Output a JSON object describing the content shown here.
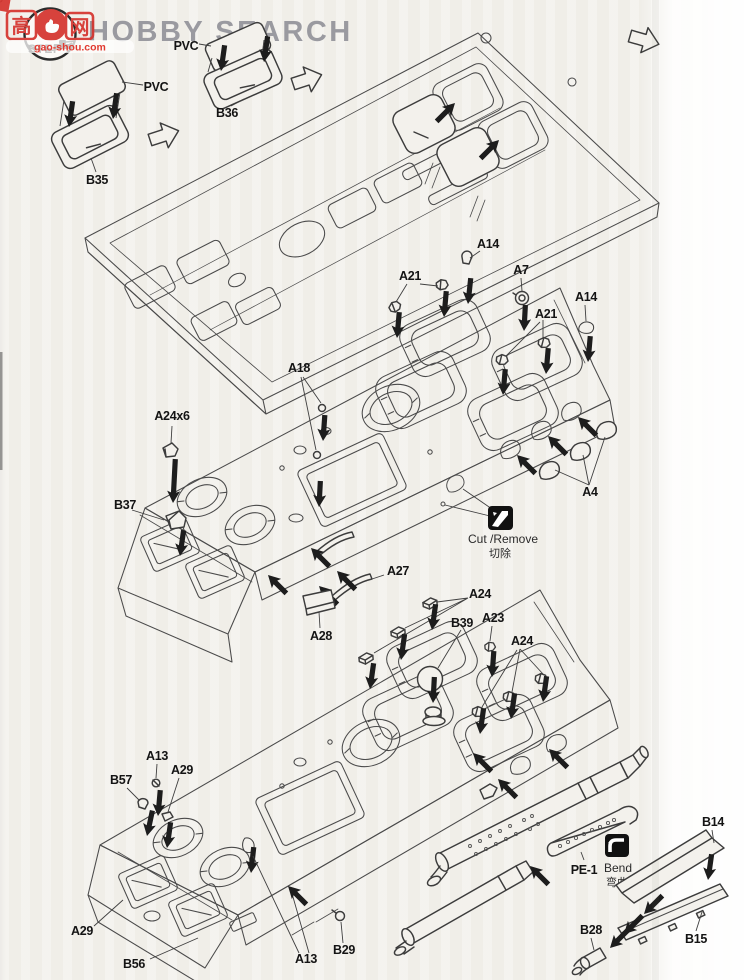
{
  "header": {
    "brand": "HOBBY SEARCH"
  },
  "watermark": {
    "cn_left": "高",
    "cn_right": "网",
    "url": "gao-shou.com",
    "badge": "STEP"
  },
  "step1": {
    "pvc_left": "PVC",
    "pvc_right": "PVC",
    "b35": "B35",
    "b36": "B36"
  },
  "step2": {
    "a14_left": "A14",
    "a21_left": "A21",
    "a7": "A7",
    "a21_right": "A21",
    "a14_right": "A14",
    "a18": "A18",
    "a24x6": "A24x6",
    "b37": "B37",
    "a27": "A27",
    "a28": "A28",
    "a4": "A4",
    "cut_en": "Cut /Remove",
    "cut_zh": "切除"
  },
  "step3": {
    "a24_left": "A24",
    "b39": "B39",
    "a23": "A23",
    "a24_right": "A24",
    "a13_top": "A13",
    "a29_top": "A29",
    "b57": "B57",
    "a29_bottom": "A29",
    "b56": "B56",
    "a13_bottom": "A13",
    "b29": "B29",
    "pe1": "PE-1",
    "bend_en": "Bend",
    "bend_zh": "弯曲",
    "b14": "B14",
    "b15": "B15",
    "b28": "B28"
  }
}
